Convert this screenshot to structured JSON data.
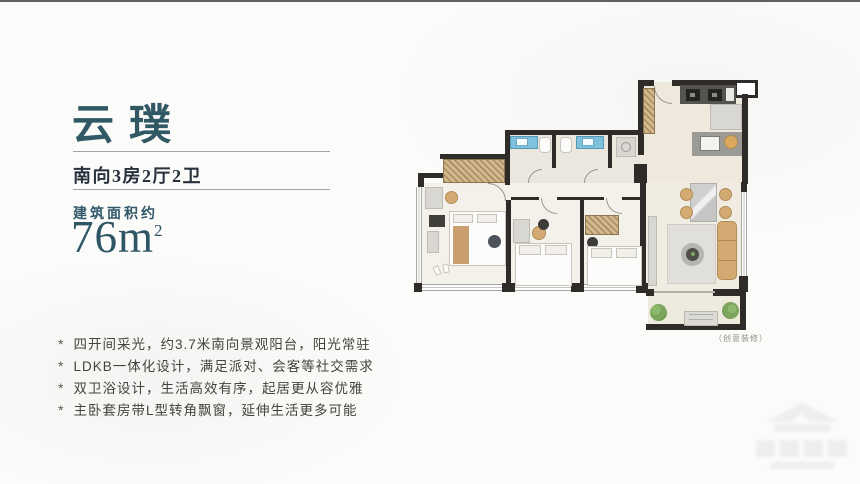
{
  "page": {
    "background": "#fbfbf9",
    "top_line_color": "#454545"
  },
  "left_panel": {
    "accent_color": "#315965",
    "title": "云璞",
    "subtitle": "南向3房2厅2卫",
    "area_label": "建筑面积约",
    "area_value": "76",
    "area_unit": "m",
    "area_exponent": "2",
    "bullet_char": "*",
    "features": [
      "四开间采光，约3.7米南向景观阳台，阳光常驻",
      "LDKB一体化设计，满足派对、会客等社交需求",
      "双卫浴设计，生活高效有序，起居更从容优雅",
      "主卧套房带L型转角飘窗，延伸生活更多可能"
    ]
  },
  "floorplan": {
    "caption": "（创意装修）",
    "colors": {
      "wall": "#2e2b28",
      "floor": "#f0ebe1",
      "sink_blue": "#7fc1dc",
      "wood_tan": "#c8a67a",
      "sofa_tan": "#d3aa72",
      "plant_green": "#7da55d"
    }
  },
  "watermark": {
    "icon": "house-logo-icon"
  }
}
